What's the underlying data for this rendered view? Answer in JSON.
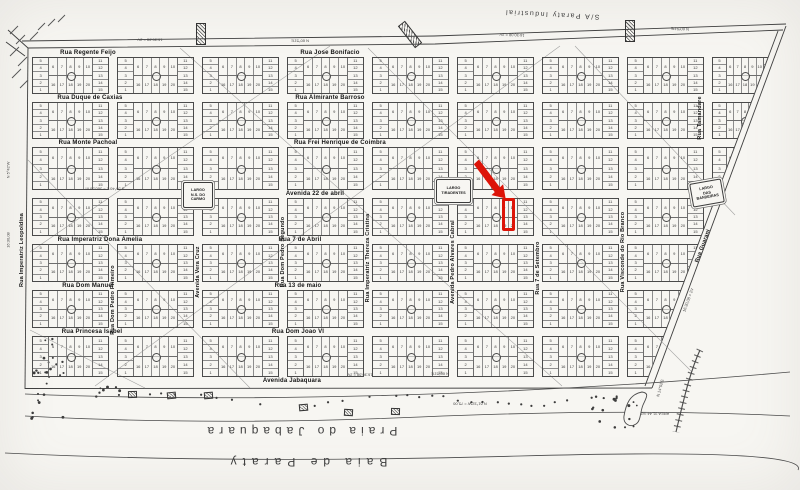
{
  "map": {
    "district": {
      "label": "S/A Paraty Industrial"
    },
    "streets_horizontal": [
      {
        "name": "Rua Regente Feijo",
        "x": 88,
        "y": 53
      },
      {
        "name": "Rua Jose Bonifacio",
        "x": 330,
        "y": 53
      },
      {
        "name": "Rua Duque de Caxias",
        "x": 90,
        "y": 98
      },
      {
        "name": "Rua Almirante Barroso",
        "x": 330,
        "y": 98
      },
      {
        "name": "Rua Monte Pachoal",
        "x": 88,
        "y": 143
      },
      {
        "name": "Rua Frei Henrique de Coimbra",
        "x": 340,
        "y": 143
      },
      {
        "name": "Avenida 22 de abril",
        "x": 315,
        "y": 194
      },
      {
        "name": "Rua Imperatriz Dona Amelia",
        "x": 100,
        "y": 240
      },
      {
        "name": "Rua 7 de Abril",
        "x": 300,
        "y": 240
      },
      {
        "name": "Rua Dom Manuel",
        "x": 88,
        "y": 286
      },
      {
        "name": "Rua 13 de maio",
        "x": 298,
        "y": 286
      },
      {
        "name": "Rua Princesa Isabel",
        "x": 92,
        "y": 332
      },
      {
        "name": "Rua Dom Joao VI",
        "x": 298,
        "y": 332
      },
      {
        "name": "Avenida Jabaquara",
        "x": 292,
        "y": 381
      }
    ],
    "streets_vertical": [
      {
        "name": "Rua Imperatriz Leopoldina",
        "x": 22,
        "y": 250
      },
      {
        "name": "Rua Dom Pedro Primeiro",
        "x": 113,
        "y": 300
      },
      {
        "name": "Avenida Vera Cruz",
        "x": 198,
        "y": 272
      },
      {
        "name": "Rua Dom Pedro Segundo",
        "x": 283,
        "y": 252
      },
      {
        "name": "Rua Imperatriz Thereza Cristina",
        "x": 368,
        "y": 258
      },
      {
        "name": "Avenida Pedro Alvares Cabral",
        "x": 453,
        "y": 262
      },
      {
        "name": "Rua 7 de Setembro",
        "x": 538,
        "y": 268
      },
      {
        "name": "Rua Visconde do Rio Branco",
        "x": 623,
        "y": 252
      },
      {
        "name": "Rua Tamandare",
        "x": 700,
        "y": 118
      }
    ],
    "streets_diagonal": [
      {
        "name": "Rua Guarani",
        "x": 703,
        "y": 246,
        "rot": -70
      }
    ],
    "largos": [
      {
        "id": "largo-ns-do-carmo",
        "lines": [
          "LARGO",
          "N.S. DO",
          "CARMO"
        ],
        "x": 183,
        "y": 182,
        "w": 28,
        "h": 24,
        "rot": 0
      },
      {
        "id": "largo-tiradentes",
        "lines": [
          "LARGO",
          "TIRADENTES"
        ],
        "x": 436,
        "y": 179,
        "w": 33,
        "h": 22,
        "rot": 0
      },
      {
        "id": "largo-das-bandeiras",
        "lines": [
          "LARGO",
          "DAS",
          "BANDEIRAS"
        ],
        "x": 691,
        "y": 181,
        "w": 30,
        "h": 22,
        "rot": -10
      }
    ],
    "shore_labels": [
      {
        "text": "Praia do Jabaquara",
        "x": 300,
        "y": 431,
        "rot": 180,
        "size": 12,
        "spacing": 5
      },
      {
        "text": "Baia de Paraty",
        "x": 306,
        "y": 462,
        "rot": 180,
        "size": 12,
        "spacing": 6
      }
    ],
    "survey_annotations": [
      {
        "text": "16:30,08 = 2V",
        "x": 150,
        "y": 40,
        "rot": 180
      },
      {
        "text": "N 60°51'E",
        "x": 300,
        "y": 41,
        "rot": 180
      },
      {
        "text": "16:30,08 = 2V",
        "x": 512,
        "y": 35,
        "rot": 182
      },
      {
        "text": "N 60°51'E",
        "x": 680,
        "y": 29,
        "rot": 182
      },
      {
        "text": "S 55°40'E = 560,00 m",
        "x": 105,
        "y": 189,
        "rot": 180
      },
      {
        "text": "16:30,08 = 2V",
        "x": 360,
        "y": 375,
        "rot": 180
      },
      {
        "text": "N 60°51'E",
        "x": 440,
        "y": 374,
        "rot": 180
      },
      {
        "text": "N 5°42'W",
        "x": 8,
        "y": 170,
        "rot": -90
      },
      {
        "text": "16:30,08",
        "x": 8,
        "y": 240,
        "rot": -90
      },
      {
        "text": "16:30,08 = 2V",
        "x": 688,
        "y": 300,
        "rot": -70
      },
      {
        "text": "N 14°52'E",
        "x": 660,
        "y": 388,
        "rot": -75
      },
      {
        "text": "N 61°32'W = 75,00",
        "x": 470,
        "y": 404,
        "rot": 180
      },
      {
        "text": "AREA 31,44 m2",
        "x": 655,
        "y": 414,
        "rot": 180
      }
    ],
    "lot_pattern": {
      "left": [
        5,
        4,
        3,
        2,
        1
      ],
      "mid_top": [
        6,
        7,
        8,
        9,
        10
      ],
      "mid_bottom": [
        16,
        17,
        18,
        19,
        20
      ],
      "right": [
        11,
        12,
        13,
        14,
        15
      ]
    },
    "red_annotation": {
      "color": "#dd1408",
      "arrow": {
        "from": [
          474,
          164
        ],
        "tip": [
          508,
          196
        ]
      },
      "rect": {
        "x": 502,
        "y": 198,
        "w": 13,
        "h": 33
      }
    }
  }
}
